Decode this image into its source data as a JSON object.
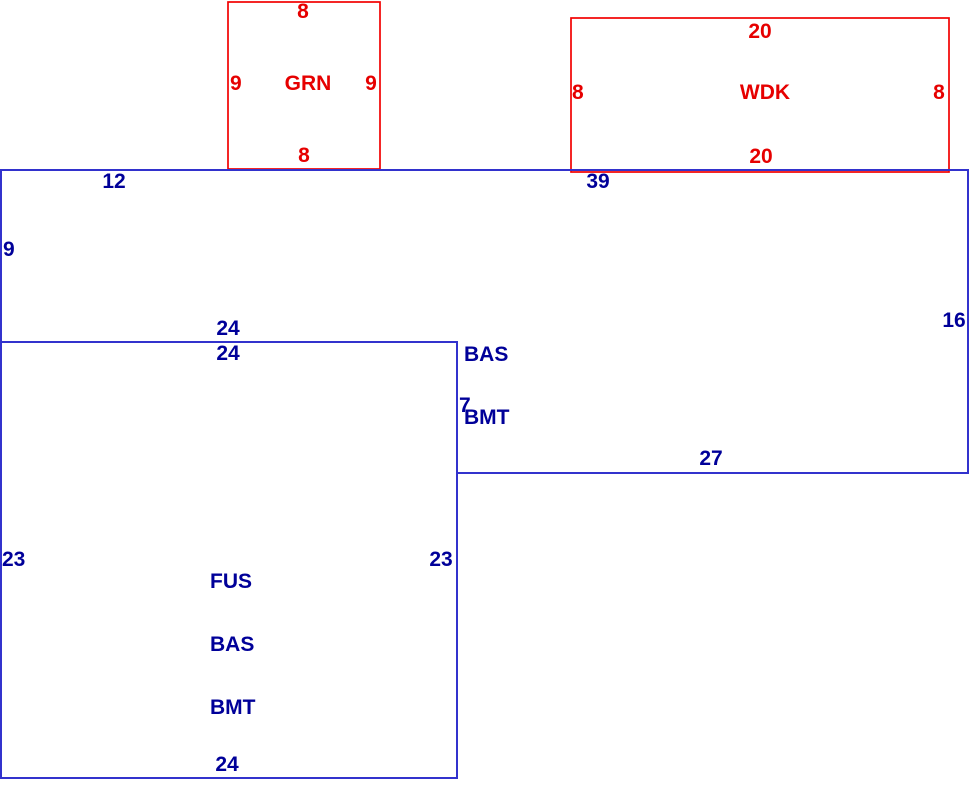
{
  "sketch": {
    "background": "#ffffff",
    "colors": {
      "attachment_line": "#f20000",
      "attachment_text": "#e60000",
      "main_line": "#3232cd",
      "main_text": "#000099"
    },
    "areas": {
      "grn": {
        "label": "GRN",
        "dim_top": "8",
        "dim_left": "9",
        "dim_right": "9",
        "dim_bottom": "8"
      },
      "wdk": {
        "label": "WDK",
        "dim_top": "20",
        "dim_left": "8",
        "dim_right": "8",
        "dim_bottom": "20"
      },
      "bas_bmt": {
        "label_line1": "BAS",
        "label_line2": "BMT",
        "dim_top_left": "12",
        "dim_top_right": "39",
        "dim_left": "9",
        "dim_right": "16",
        "dim_inner_bottom": "24",
        "dim_step": "7",
        "dim_bottom_right": "27"
      },
      "fus_bas_bmt": {
        "label_line1": "FUS",
        "label_line2": "BAS",
        "label_line3": "BMT",
        "dim_top": "24",
        "dim_left": "23",
        "dim_right": "23",
        "dim_bottom": "24"
      }
    }
  }
}
